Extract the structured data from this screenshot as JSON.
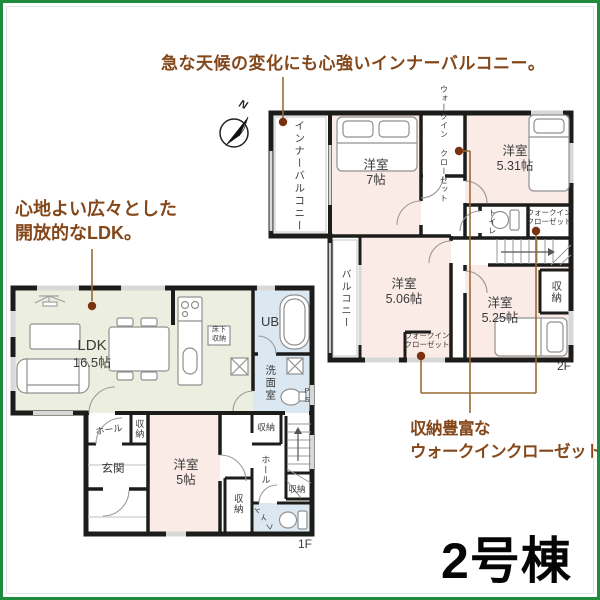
{
  "annotations": {
    "top": "急な天候の変化にも心強いインナーバルコニー。",
    "ldk_line1": "心地よい広々とした",
    "ldk_line2": "開放的なLDK。",
    "wic_line1": "収納豊富な",
    "wic_line2": "ウォークインクローゼット。",
    "color": "#84471a"
  },
  "building_label": "2号棟",
  "compass": {
    "north": "N"
  },
  "floor2": {
    "label": "2F",
    "inner_balcony": "インナーバルコニー",
    "balcony": "バルコニー",
    "bedroom7": {
      "name": "洋室",
      "size": "7帖"
    },
    "bedroom531": {
      "name": "洋室",
      "size": "5.31帖"
    },
    "bedroom506": {
      "name": "洋室",
      "size": "5.06帖"
    },
    "bedroom525": {
      "name": "洋室",
      "size": "5.25帖"
    },
    "wic_top": {
      "line1": "ウォークイン",
      "line2": "クローゼット"
    },
    "wic_right": {
      "line1": "ウォークイン",
      "line2": "クローゼット"
    },
    "wic_bottom": {
      "line1": "ウォークイン",
      "line2": "クローゼット"
    },
    "toilet": "トイレ",
    "storage": "収納"
  },
  "floor1": {
    "label": "1F",
    "ldk": {
      "name": "LDK",
      "size": "16.5帖"
    },
    "floor_storage": {
      "line1": "床下",
      "line2": "収納"
    },
    "bath": "UB",
    "washroom": "洗面室",
    "pipe_space": "PS",
    "hall_upper": "ホール",
    "hall_lower": "ホール",
    "entrance": "玄関",
    "bedroom5": {
      "name": "洋室",
      "size": "5帖"
    },
    "storage_hall": "収納",
    "storage_upper_right": "収納",
    "storage_mid": "収納",
    "storage_right": "収納",
    "toilet": "トイレ"
  },
  "colors": {
    "frame_green": "#1e8a3c",
    "wall": "#1c1c1a",
    "bedroom_floor": "#faebe6",
    "ldk_floor": "#ecefdf",
    "wet_floor": "#dbe8f1",
    "annotation_brown": "#84471a",
    "callout_line": "#9a6a35",
    "callout_dot": "#7a3110"
  }
}
